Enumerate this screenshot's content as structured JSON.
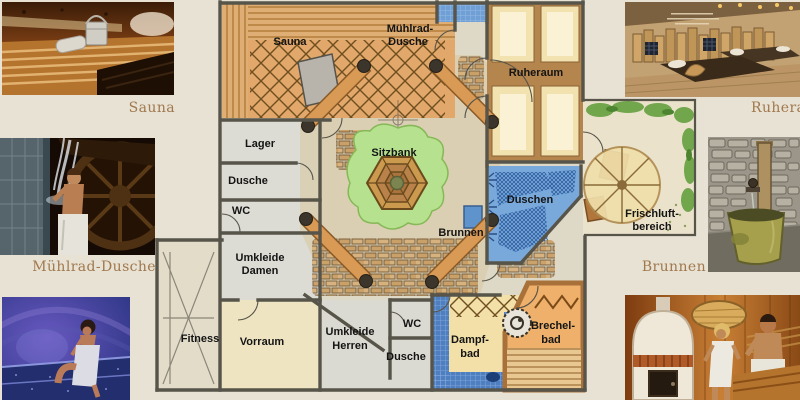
{
  "page": {
    "background": "#e7e2d3"
  },
  "captions": {
    "sauna": "Sauna",
    "muehlrad_dusche": "Mühlrad-Dusche",
    "ruheraum": "Ruheraum",
    "brunnen": "Brunnen"
  },
  "plan": {
    "labels": {
      "sauna": "Sauna",
      "muehlrad_line1": "Mühlrad-",
      "muehlrad_line2": "Dusche",
      "ruheraum": "Ruheraum",
      "lager": "Lager",
      "dusche_damen": "Dusche",
      "wc_damen": "WC",
      "umkleide_damen_line1": "Umkleide",
      "umkleide_damen_line2": "Damen",
      "sitzbank": "Sitzbank",
      "brunnen": "Brunnen",
      "duschen": "Duschen",
      "frischluft_line1": "Frischluft-",
      "frischluft_line2": "bereich",
      "fitness": "Fitness",
      "vorraum": "Vorraum",
      "umkleide_herren_line1": "Umkleide",
      "umkleide_herren_line2": "Herren",
      "wc_herren": "WC",
      "dusche_herren": "Dusche",
      "dampfbad_line1": "Dampf-",
      "dampfbad_line2": "bad",
      "brechelbad_line1": "Brechel-",
      "brechelbad_line2": "bad"
    },
    "colors": {
      "wall": "#57544a",
      "sauna_floor": "#e2a76b",
      "bench_wood": "#d99a56",
      "water_blue": "#79a9db",
      "tile_blue": "#4f7fc0",
      "lawn_green": "#b6e18e",
      "ruheraum_floor": "#b5854e",
      "bed_cream": "#f2e2b0",
      "room_grey": "#dcdbd4",
      "cream_floor": "#eee4c2",
      "brechel_orange": "#eeb06a"
    }
  }
}
